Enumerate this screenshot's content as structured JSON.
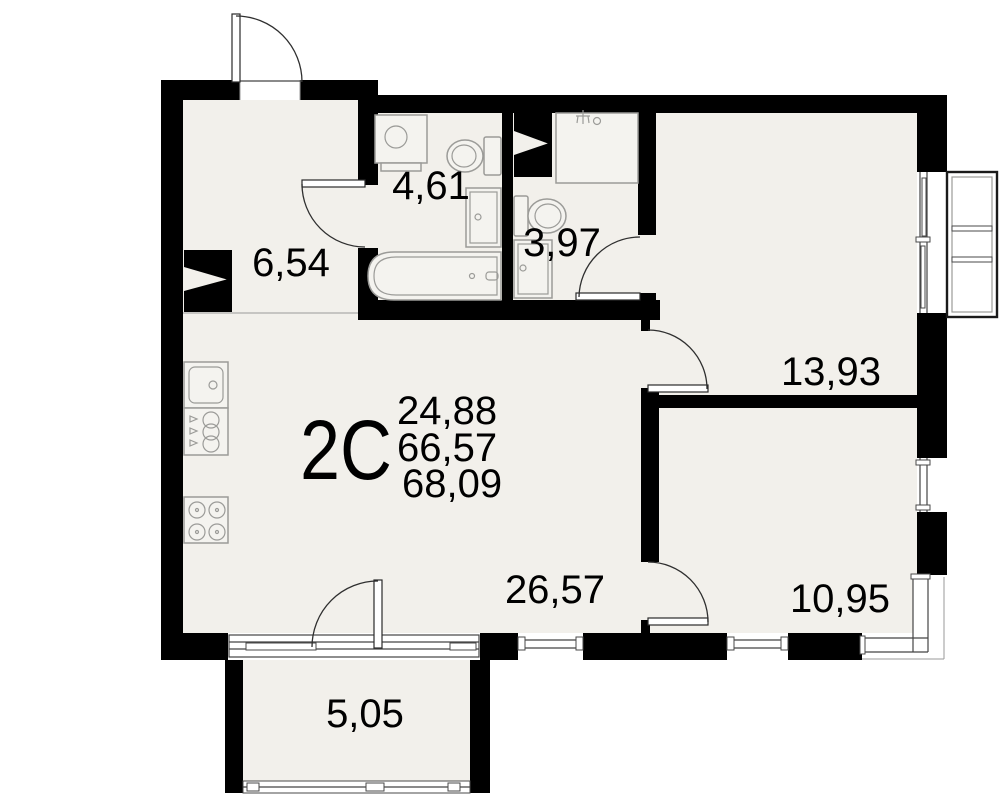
{
  "plan": {
    "unit": {
      "type_label": "2C",
      "area_living": "24,88",
      "area_main": "66,57",
      "area_total": "68,09"
    },
    "rooms": {
      "hall": "6,54",
      "bathroom": "4,61",
      "wc": "3,97",
      "bedroom1": "13,93",
      "living_kitchen": "26,57",
      "bedroom2": "10,95",
      "balcony": "5,05"
    },
    "colors": {
      "wall": "#000000",
      "floor": "#f2f0eb",
      "fixture_line": "#9b9b98",
      "detail_line": "#444444"
    }
  }
}
